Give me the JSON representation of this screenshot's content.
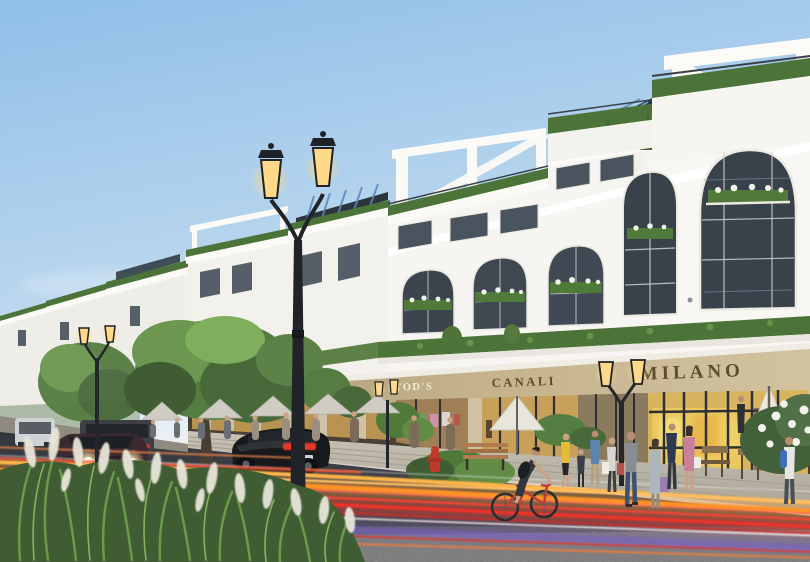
{
  "scene": {
    "title": "Twilight shophouse street render",
    "description": "Photorealistic architectural rendering at dusk: a receding row of white neoclassical shophouses with rooftop pergola terraces, hedge balustrades, arched windows with flower boxes, ground-floor luxury retail with beige sign fascia, classical twin-head street lamps, sidewalk cafes with umbrellas, pedestrians with shopping bags, a cyclist, parked cars and long-exposure traffic light trails, ornamental grass in the foreground.",
    "time_of_day": "dusk",
    "signs": {
      "thai_food": "THAI FOOD",
      "zara": "ZARA",
      "haidilao": "HAIDILAO",
      "tods": "TOD'S",
      "canali": "CANALI",
      "milano": "MILANO"
    },
    "vehicles": [
      "white van",
      "dark gray van",
      "dark sedan with headlights on",
      "black sedan driving away with red tail lights"
    ],
    "street_furniture": [
      "classical twin-head street lamps",
      "cafe umbrellas",
      "wooden bench",
      "red fire hydrant"
    ],
    "people": "pedestrians with shopping bags, cafe guests, one cyclist on a red bicycle",
    "palette": {
      "sky_top": "#8fbfe8",
      "sky_horizon": "#eef2f5",
      "facade_white": "#f6f5f1",
      "fascia_beige": "#c3b28c",
      "sign_bronze": "#5f4e2a",
      "sign_cream": "#f3ecd6",
      "hedge_green": "#4c7438",
      "foliage_green": "#5d8247",
      "road_asphalt": "#3c3f45",
      "sidewalk_stone": "#b9b3a7",
      "trail_red": "#ff4334",
      "trail_orange": "#ffa13d",
      "trail_violet": "#7a5ed0",
      "lamp_glow": "#ffd98a",
      "headlight_warm": "#fff3c4",
      "grass_green": "#6b9a4a",
      "plume_cream": "#e9e6da"
    }
  }
}
